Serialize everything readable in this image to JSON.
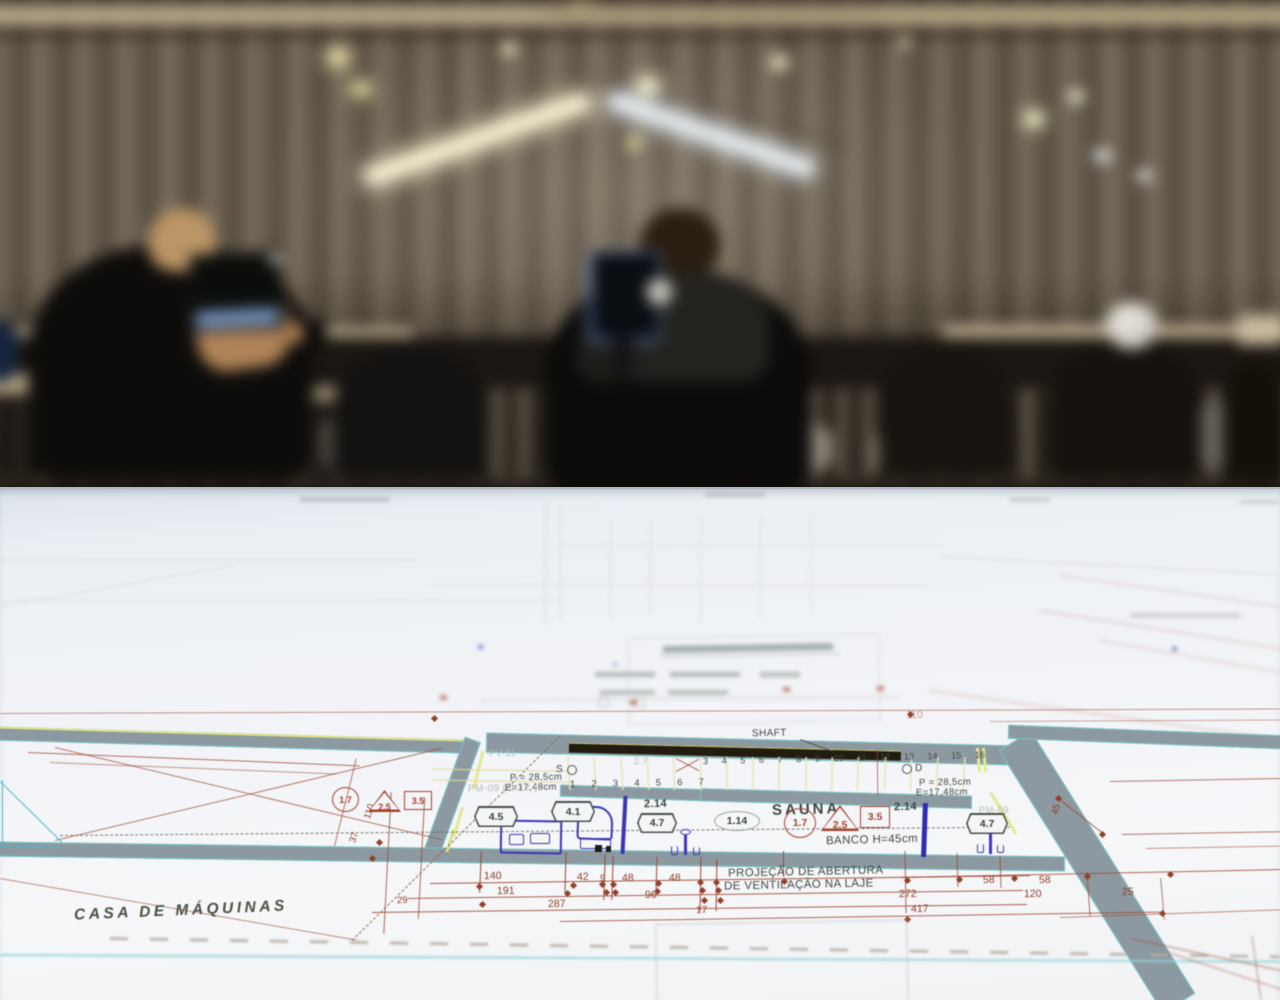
{
  "scene": {
    "setting": "Out-of-focus open-plan studio: two people working at computers along a long desk in front of a slatted wall with a lit roof truss; an architectural floor plan sheet fills the foreground table",
    "colors": {
      "paper": "#f1f3f7",
      "wall_band": "#8d99a1",
      "wall_edge_cyan": "#74c6c4",
      "accent_yellow": "#e4e88e",
      "line_red": "#9c4631",
      "dim_text_red": "#8e3b26",
      "label_dark": "#3e463f",
      "fixture_blue": "#3c35b5",
      "shaft_black": "#221b10"
    }
  },
  "blueprint": {
    "labels": [
      {
        "t": "SHAFT",
        "x": 752,
        "y": 728,
        "s": 10,
        "r": -1,
        "c": ""
      },
      {
        "t": "SAUNA",
        "x": 772,
        "y": 801,
        "s": 15,
        "r": -1.5,
        "c": "ls3"
      },
      {
        "t": "BANCO H=45cm",
        "x": 826,
        "y": 834,
        "s": 11.5,
        "r": -1.5,
        "c": ""
      },
      {
        "t": "PROJEÇÃO DE ABERTURA",
        "x": 728,
        "y": 866,
        "s": 11.5,
        "r": -1.2,
        "c": ""
      },
      {
        "t": "DE VENTILAÇÃO NA LAJE",
        "x": 724,
        "y": 879,
        "s": 11.5,
        "r": -1.2,
        "c": ""
      },
      {
        "t": "CASA DE MÁQUINAS",
        "x": 74,
        "y": 902,
        "s": 15.5,
        "r": -2.5,
        "c": "casa"
      },
      {
        "t": "P = 28,5cm",
        "x": 510,
        "y": 772,
        "s": 9.5,
        "r": -1,
        "c": ""
      },
      {
        "t": "E=17,48cm",
        "x": 505,
        "y": 782,
        "s": 9.5,
        "r": -1,
        "c": ""
      },
      {
        "t": "P = 28,5cm",
        "x": 919,
        "y": 777,
        "s": 9.5,
        "r": -1,
        "c": ""
      },
      {
        "t": "E=17,48cm",
        "x": 916,
        "y": 787,
        "s": 9.5,
        "r": -1,
        "c": ""
      },
      {
        "t": "S",
        "x": 556,
        "y": 764,
        "s": 10,
        "r": 0,
        "c": ""
      },
      {
        "t": "D",
        "x": 915,
        "y": 763,
        "s": 10,
        "r": 0,
        "c": ""
      },
      {
        "t": "PV-11",
        "x": 489,
        "y": 748,
        "s": 9.5,
        "r": -1,
        "c": "faint"
      },
      {
        "t": "PM-09  ( 1.12 )",
        "x": 468,
        "y": 783,
        "s": 10,
        "r": -1,
        "c": "faint"
      },
      {
        "t": "PM-09",
        "x": 979,
        "y": 805,
        "s": 9.5,
        "r": -1,
        "c": "faint"
      },
      {
        "t": "2.7",
        "x": 634,
        "y": 756,
        "s": 9,
        "r": -1,
        "c": "faint"
      },
      {
        "t": "2.14",
        "x": 644,
        "y": 798,
        "s": 11,
        "r": -1,
        "c": "num"
      },
      {
        "t": "2.14",
        "x": 894,
        "y": 801,
        "s": 11,
        "r": -1,
        "c": "num"
      }
    ],
    "dimensions": [
      {
        "t": "140",
        "x": 484,
        "y": 870
      },
      {
        "t": "42",
        "x": 577,
        "y": 871
      },
      {
        "t": "9",
        "x": 600,
        "y": 873,
        "s": 9.5
      },
      {
        "t": "48",
        "x": 622,
        "y": 872
      },
      {
        "t": "48",
        "x": 669,
        "y": 872
      },
      {
        "t": "96",
        "x": 645,
        "y": 889
      },
      {
        "t": "191",
        "x": 497,
        "y": 885
      },
      {
        "t": "287",
        "x": 548,
        "y": 898
      },
      {
        "t": "17",
        "x": 696,
        "y": 905,
        "s": 10
      },
      {
        "t": "29",
        "x": 397,
        "y": 895,
        "s": 9.5
      },
      {
        "t": "58",
        "x": 983,
        "y": 874
      },
      {
        "t": "58",
        "x": 1039,
        "y": 874
      },
      {
        "t": "272",
        "x": 899,
        "y": 888
      },
      {
        "t": "417",
        "x": 911,
        "y": 903
      },
      {
        "t": "120",
        "x": 1024,
        "y": 888
      },
      {
        "t": "25",
        "x": 1122,
        "y": 886
      },
      {
        "t": "110",
        "x": 362,
        "y": 806,
        "r": -72,
        "s": 9.5
      },
      {
        "t": "37",
        "x": 349,
        "y": 832,
        "r": -72,
        "s": 9.5
      },
      {
        "t": "45",
        "x": 1051,
        "y": 804,
        "r": -75,
        "s": 9.5
      },
      {
        "t": "110",
        "x": 906,
        "y": 709,
        "c": "faint"
      }
    ],
    "symbols": [
      {
        "t": "4.5",
        "x": 474,
        "y": 806,
        "w": 44,
        "h": 21,
        "c": "hex"
      },
      {
        "t": "4.1",
        "x": 551,
        "y": 801,
        "w": 44,
        "h": 21,
        "c": "hex"
      },
      {
        "t": "4.7",
        "x": 637,
        "y": 813,
        "w": 40,
        "h": 20,
        "c": "hex"
      },
      {
        "t": "4.7",
        "x": 966,
        "y": 813,
        "w": 42,
        "h": 21,
        "c": "hex"
      },
      {
        "t": "1.14",
        "x": 714,
        "y": 811,
        "w": 46,
        "h": 20,
        "c": "ell"
      },
      {
        "t": "1.7",
        "x": 784,
        "y": 808,
        "w": 32,
        "h": 30,
        "c": "circ"
      },
      {
        "t": "2.5",
        "x": 821,
        "y": 805,
        "w": 38,
        "h": 26,
        "c": "tri"
      },
      {
        "t": "3.5",
        "x": 860,
        "y": 806,
        "w": 30,
        "h": 22,
        "c": "sq"
      },
      {
        "t": "1.7",
        "x": 332,
        "y": 787,
        "w": 27,
        "h": 25,
        "c": "circ sm"
      },
      {
        "t": "2.5",
        "x": 368,
        "y": 790,
        "w": 33,
        "h": 22,
        "c": "tri sm"
      },
      {
        "t": "3.5",
        "x": 404,
        "y": 791,
        "w": 28,
        "h": 19,
        "c": "sq sm"
      }
    ],
    "stairs": {
      "top_row": [
        "3",
        "4",
        "5",
        "6",
        "7",
        "8",
        "9",
        "10",
        "11",
        "12",
        "13",
        "14",
        "15",
        "16"
      ],
      "bottom_row": [
        "1",
        "2",
        "3",
        "4",
        "5",
        "6",
        "7"
      ]
    }
  }
}
